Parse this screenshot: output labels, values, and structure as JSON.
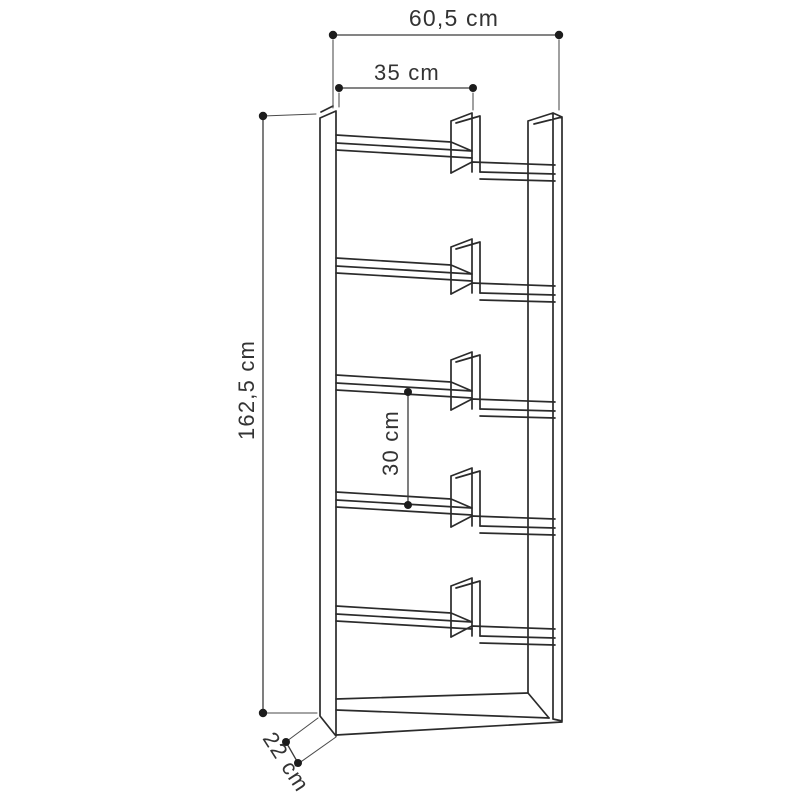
{
  "diagram": {
    "type": "furniture dimension drawing",
    "subject": "staggered-shelf bookcase",
    "background_color": "#ffffff",
    "line_color": "#2b2b2b",
    "text_color": "#333333",
    "dimensions": {
      "overall_width": "60,5 cm",
      "shelf_width": "35 cm",
      "overall_height": "162,5 cm",
      "shelf_spacing": "30 cm",
      "depth": "22 cm"
    }
  }
}
